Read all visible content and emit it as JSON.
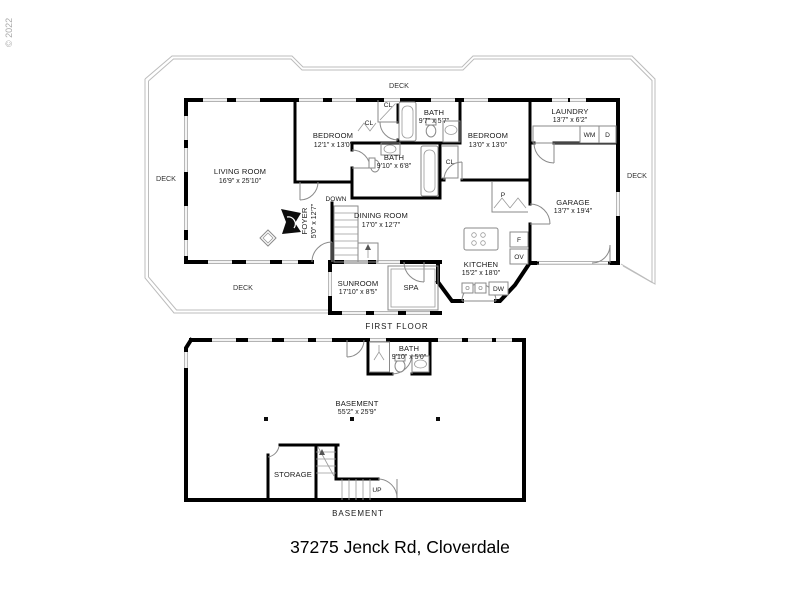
{
  "watermark": {
    "copyright": "© 2022"
  },
  "footer": {
    "address": "37275 Jenck Rd, Cloverdale"
  },
  "colors": {
    "walls": "#000000",
    "thin_lines": "#8a8a8a",
    "deck_outline": "#bcbcbc"
  },
  "first_floor": {
    "caption": "FIRST FLOOR",
    "deck": "DECK",
    "down": "DOWN",
    "closet": "CL",
    "rooms": {
      "living": {
        "name": "LIVING ROOM",
        "dims": "16'9\" x 25'10\""
      },
      "bedroom1": {
        "name": "BEDROOM",
        "dims": "12'1\" x 13'0\""
      },
      "bath1": {
        "name": "BATH",
        "dims": "9'7\" x 5'7\""
      },
      "bath2": {
        "name": "BATH",
        "dims": "9'10\" x 6'8\""
      },
      "bedroom2": {
        "name": "BEDROOM",
        "dims": "13'0\" x 13'0\""
      },
      "laundry": {
        "name": "LAUNDRY",
        "dims": "13'7\" x 6'2\""
      },
      "garage": {
        "name": "GARAGE",
        "dims": "13'7\" x 19'4\""
      },
      "kitchen": {
        "name": "KITCHEN",
        "dims": "15'2\" x 18'0\""
      },
      "dining": {
        "name": "DINING ROOM",
        "dims": "17'0\" x 12'7\""
      },
      "foyer": {
        "name": "FOYER",
        "dims": "5'0\" x 12'7\""
      },
      "sunroom": {
        "name": "SUNROOM",
        "dims": "17'10\" x 8'5\""
      },
      "spa": {
        "name": "SPA"
      }
    },
    "appliances": {
      "pantry": "P",
      "fridge": "F",
      "oven": "OV",
      "dishwasher": "DW",
      "washer": "WM",
      "dryer": "D"
    }
  },
  "basement": {
    "caption": "BASEMENT",
    "up": "UP",
    "area": {
      "name": "BASEMENT",
      "dims": "55'2\" x 25'9\""
    },
    "rooms": {
      "bath": {
        "name": "BATH",
        "dims": "9'10\" x 5'0\""
      },
      "storage": {
        "name": "STORAGE"
      }
    }
  }
}
